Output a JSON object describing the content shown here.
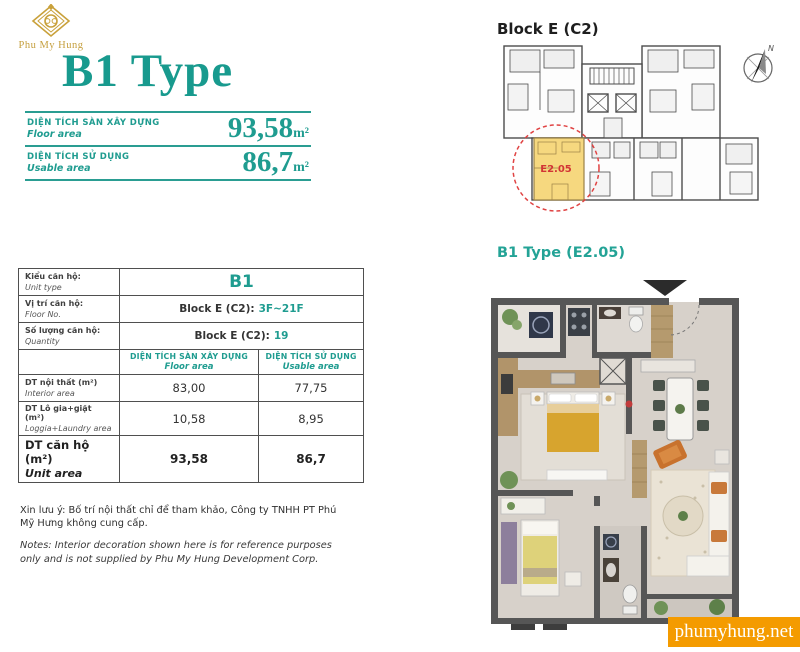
{
  "brand": {
    "name": "Phu My Hung"
  },
  "title": "B1 Type",
  "summary": {
    "floor": {
      "label_vi": "DIỆN TÍCH SÀN XÂY DỰNG",
      "label_en": "Floor area",
      "value": "93,58",
      "unit": "m²"
    },
    "usable": {
      "label_vi": "DIỆN TÍCH SỬ DỤNG",
      "label_en": "Usable area",
      "value": "86,7",
      "unit": "m²"
    }
  },
  "table": {
    "unit_type": {
      "label_vi": "Kiểu căn hộ:",
      "label_en": "Unit type",
      "value": "B1"
    },
    "floor_no": {
      "label_vi": "Vị trí căn hộ:",
      "label_en": "Floor No.",
      "prefix": "Block E (C2):",
      "value": "3F~21F"
    },
    "quantity": {
      "label_vi": "Số lượng căn hộ:",
      "label_en": "Quantity",
      "prefix": "Block E (C2):",
      "value": "19"
    },
    "col_floor": {
      "vi": "DIỆN TÍCH SÀN XÂY DỰNG",
      "en": "Floor area"
    },
    "col_usable": {
      "vi": "DIỆN TÍCH SỬ DỤNG",
      "en": "Usable area"
    },
    "interior": {
      "label_vi": "DT nội thất  (m²)",
      "label_en": "Interior area",
      "floor": "83,00",
      "usable": "77,75"
    },
    "loggia": {
      "label_vi": "DT Lô gia+giặt  (m²)",
      "label_en": "Loggia+Laundry area",
      "floor": "10,58",
      "usable": "8,95"
    },
    "total": {
      "label_vi": "DT căn hộ (m²)",
      "label_en": "Unit area",
      "floor": "93,58",
      "usable": "86,7"
    }
  },
  "notes": {
    "vi": "Xin lưu ý: Bố trí nội thất chỉ để tham khảo, Công ty TNHH PT Phú Mỹ Hưng không cung cấp.",
    "en": "Notes: Interior decoration shown here is for reference purposes only and is not supplied by Phu My Hung Development Corp."
  },
  "block_plan": {
    "title": "Block E (C2)",
    "unit_label": "E2.05",
    "compass_label": "N"
  },
  "unit_plan": {
    "title": "B1 Type (E2.05)"
  },
  "watermark": {
    "text": "phumyhung.net"
  },
  "colors": {
    "teal": "#1f9c90",
    "gold": "#c59f3e",
    "orange": "#f49b00",
    "red": "#e04343",
    "unit_yellow": "#f6d87f"
  }
}
